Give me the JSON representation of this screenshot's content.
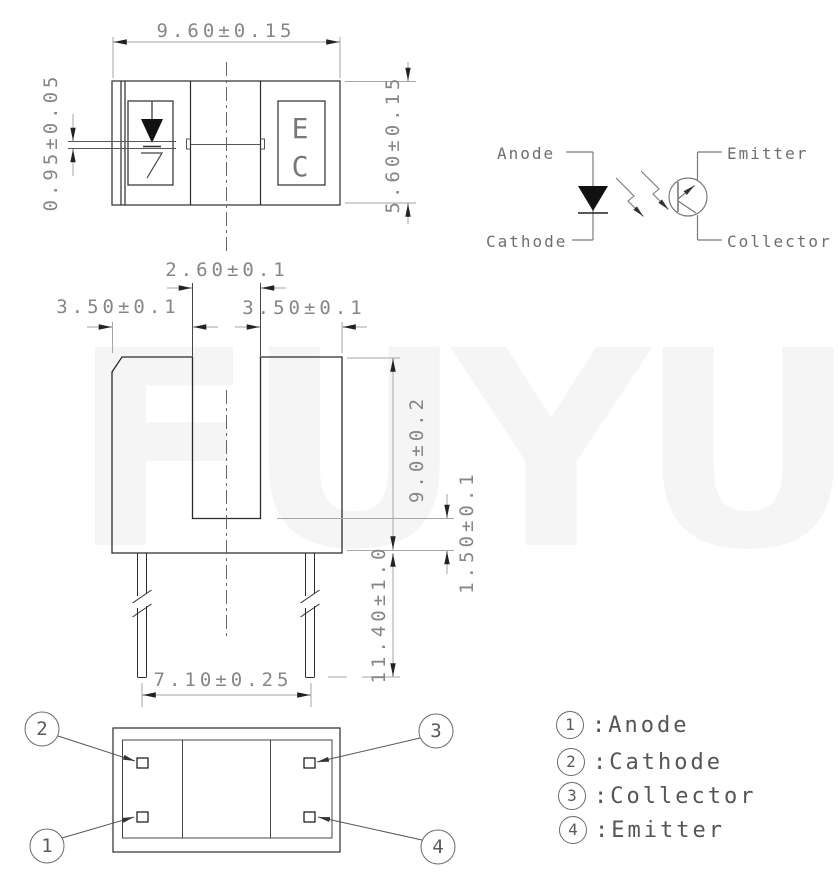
{
  "watermark": "FUYU",
  "top_view": {
    "dim_width": "9.60±0.15",
    "dim_height": "5.60±0.15",
    "dim_aperture": "0.95±0.05",
    "dim_slot_width": "2.60±0.1",
    "emitter_mark": "E",
    "collector_mark": "C"
  },
  "front_view": {
    "dim_left_tower": "3.50±0.1",
    "dim_right_tower": "3.50±0.1",
    "dim_body_height": "9.0±0.2",
    "dim_slot_floor": "1.50±0.1",
    "dim_lead_length": "11.40±1.0",
    "dim_lead_pitch": "7.10±0.25"
  },
  "schematic": {
    "anode_label": "Anode",
    "cathode_label": "Cathode",
    "emitter_label": "Emitter",
    "collector_label": "Collector"
  },
  "bottom_view": {
    "callouts": {
      "top_left": "2",
      "bottom_left": "1",
      "top_right": "3",
      "bottom_right": "4"
    }
  },
  "legend": {
    "items": [
      {
        "num": "1",
        "label": ":Anode"
      },
      {
        "num": "2",
        "label": ":Cathode"
      },
      {
        "num": "3",
        "label": ":Collector"
      },
      {
        "num": "4",
        "label": ":Emitter"
      }
    ]
  }
}
